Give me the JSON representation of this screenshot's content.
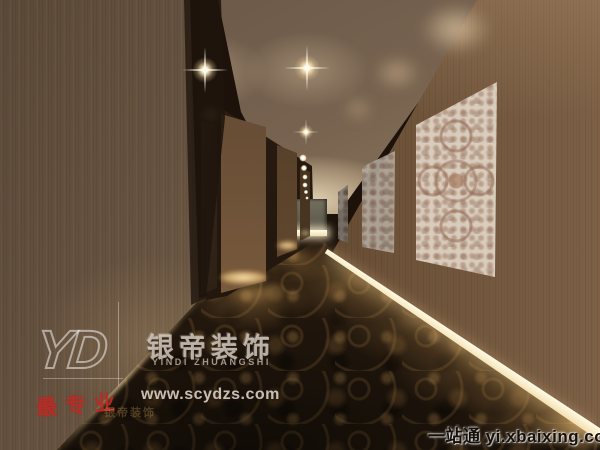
{
  "scene": {
    "subject": "hotel-corridor-interior-rendering",
    "elements": [
      "wood-walls",
      "patterned-carpet",
      "recessed-ceiling-downlights",
      "lace-art-panels",
      "lit-skirting"
    ]
  },
  "watermarks": {
    "logo_text": "YD",
    "brand_cn": "银帝装饰",
    "brand_en": "YINDI ZHUANGSHI",
    "website": "www.scydzs.com",
    "stamp_cn": "最专业",
    "faint_brand_cn": "银帝装饰",
    "portal_footer": "一站通 yi.xbaixing.com"
  },
  "colors": {
    "left_wall_wood": "#74604a",
    "right_wall_wood": "#5f4733",
    "ceiling": "#937c63",
    "carpet_dark": "#2a1c10",
    "carpet_gold": "#9c7544",
    "skirting_light": "#fdf2d4",
    "lace_panel": "#e7ddce",
    "end_wall": "#67655a",
    "stamp_red": "#c22c26",
    "portal_text": "#17100a"
  }
}
